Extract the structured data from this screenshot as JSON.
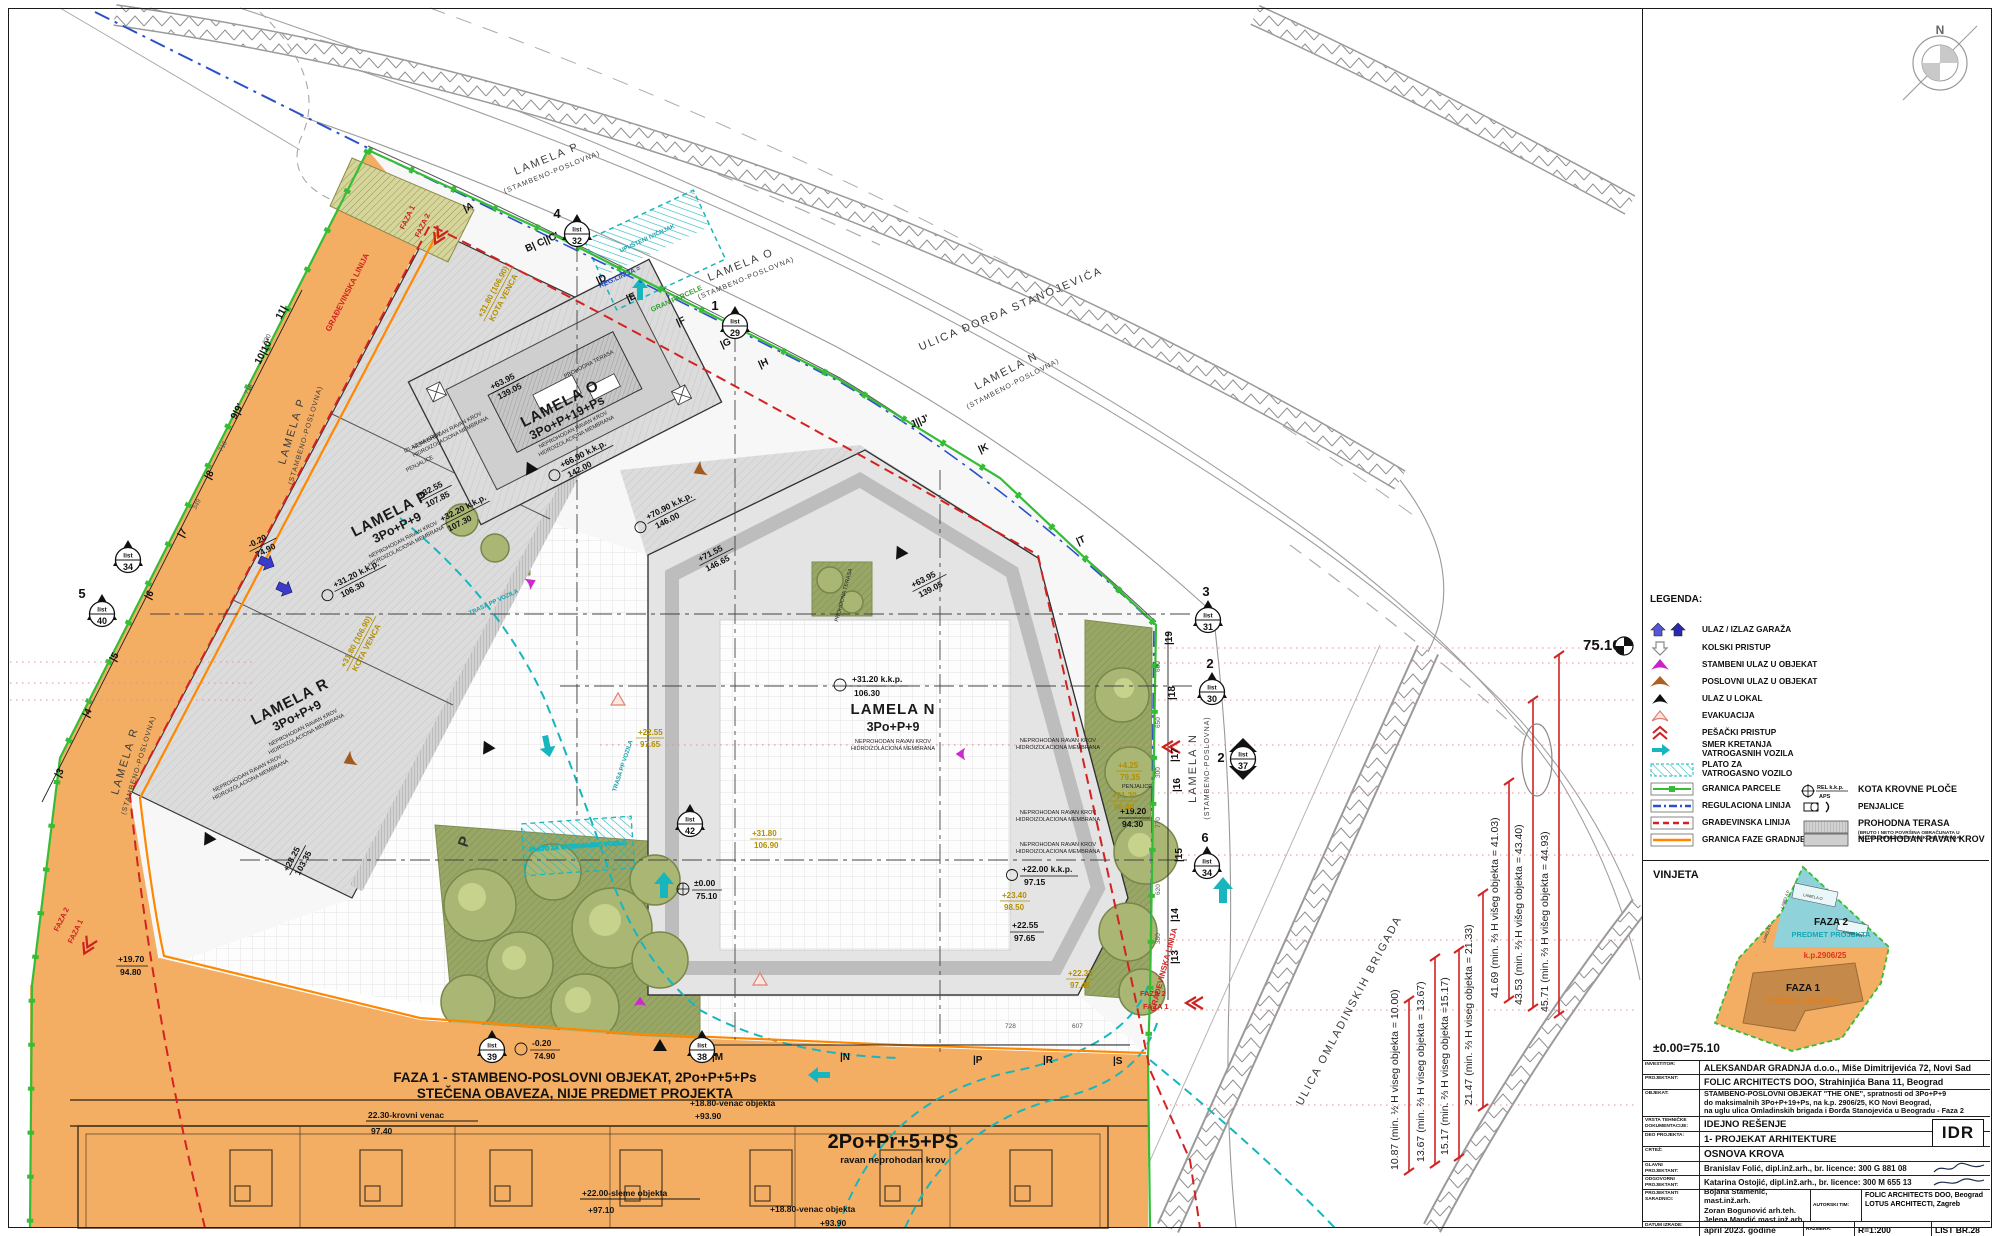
{
  "colors": {
    "orange": "#f3ae63",
    "cyan": "#17b6be",
    "green": "#35bd35",
    "red": "#d32222",
    "blue": "#2b50cc",
    "gold": "#b28f00",
    "phase_line": "#ff8800"
  },
  "compass_n": "N",
  "plan": {
    "streets": {
      "top_p": [
        "LAMELA P",
        "(STAMBENO-POSLOVNA)"
      ],
      "top_o": [
        "LAMELA O",
        "(STAMBENO-POSLOVNA)"
      ],
      "djordja": "ULICA ĐORĐA STANOJEVIĆA",
      "top_n": [
        "LAMELA N",
        "(STAMBENO-POSLOVNA)"
      ],
      "east_n": [
        "LAMELA N",
        "(STAMBENO-POSLOVNA)"
      ],
      "west_p": [
        "LAMELA P",
        "(STAMBENO-POSLOVNA)"
      ],
      "west_r": [
        "LAMELA R",
        "(STAMBENO-POSLOVNA)"
      ],
      "omladinskih": "ULICA OMLADINSKIH BRIGADA"
    },
    "buildings": {
      "o": {
        "name": "LAMELA O",
        "floors": "3Po+P+19+Ps"
      },
      "p": {
        "name": "LAMELA P",
        "floors": "3Po+P+9"
      },
      "r": {
        "name": "LAMELA R",
        "floors": "3Po+P+9"
      },
      "n": {
        "name": "LAMELA N",
        "floors": "3Po+P+9"
      }
    },
    "roof_notes": [
      "NEPROHODAN RAVAN KROV",
      "HIDROIZOLACIONA MEMBRANA"
    ],
    "faza1_title": [
      "FAZA 1 - STAMBENO-POSLOVNI OBJEKAT, 2Po+P+5+Ps",
      "STEČENA OBAVEZA, NIJE PREDMET PROJEKTA"
    ],
    "faza1_building": [
      "2Po+Pr+5+PS",
      "ravan neprohodan krov"
    ],
    "bottom_notes": {
      "krovni": [
        "22.30-krovni venac",
        "97.40"
      ],
      "venac1": [
        "+18.80-venac objekta",
        "+93.90"
      ],
      "sleme": [
        "+22.00-sleme objekta",
        "+97.10"
      ],
      "venac2": [
        "+18.80-venac objekta",
        "+93.90"
      ]
    },
    "phase": {
      "f1": "FAZA 1",
      "f2": "FAZA 2"
    },
    "notes": {
      "trasa": "TRASA PP VOZILA",
      "plato": "PLATO ZA VATROGASNO VOZILO",
      "upusteni": "UPUŠTENI IVIČNJAK",
      "reg": "REG.LINIJA =",
      "gran": "GRAN.PARCELE",
      "gradj": "GRAĐEVINSKA LINIJA",
      "penjalice": "PENJALICE",
      "prohodna": "PROHODNA TERASA",
      "izlaz": "IZLAZ NA KROV",
      "parking": "P"
    },
    "elevations": [
      {
        "a": "+70.90 k.k.p.",
        "b": "146.00"
      },
      {
        "a": "+71.55",
        "b": "146.65"
      },
      {
        "a": "+63.95",
        "b": "139.05"
      },
      {
        "a": "+63.95",
        "b": "139.05"
      },
      {
        "a": "+31.20 k.k.p.",
        "b": "106.30"
      },
      {
        "a": "+31.20 k.k.p.",
        "b": "106.30"
      },
      {
        "a": "+66.90 k.k.p.",
        "b": "142.00"
      },
      {
        "a": "+32.55",
        "b": "107.85"
      },
      {
        "a": "+32.20 k.k.p.",
        "b": "107.30"
      },
      {
        "a": "+22.00 k.k.p.",
        "b": "97.15"
      },
      {
        "a": "+22.55",
        "b": "97.65"
      },
      {
        "a": "+19.20",
        "b": "94.30"
      },
      {
        "a": "±0.00",
        "b": "75.10"
      },
      {
        "a": "-0.20",
        "b": "74.90"
      },
      {
        "a": "-0.20",
        "b": "74.90"
      },
      {
        "a": "+19.70",
        "b": "94.80"
      },
      {
        "a": "+28.25",
        "b": "103.35"
      }
    ],
    "gold": [
      {
        "a": "+31.80 (106.90)",
        "b": "KOTA VENCA"
      },
      {
        "a": "+31.80 (106.90)",
        "b": "KOTA VENCA"
      },
      {
        "a": "+31.80",
        "b": "106.90"
      },
      {
        "a": "+23.40",
        "b": "98.50"
      },
      {
        "a": "+4.25",
        "b": "79.35"
      },
      {
        "a": "+22.55",
        "b": "97.65"
      },
      {
        "a": "+21.30",
        "b": "96.40"
      },
      {
        "a": "+22.35",
        "b": "97.45"
      }
    ],
    "dims": [
      "10.87 (min. ½ H viseg objekta = 10.00)",
      "13.67 (min. ⅔ H viseg objekta = 13.67)",
      "15.17 (min. ⅔ H viseg objekta =15.17)",
      "21.47 (min. ⅔ H viseg objekta = 21.33)",
      "41.69 (min. ⅔ H višeg objekta = 41.03)",
      "43.53 (min. ⅔ H višeg objekta = 43.40)",
      "45.71 (min. ⅔ H višeg objekta = 44.93)"
    ],
    "elev_ref": "75.10",
    "grid": {
      "east": [
        "|19",
        "|18",
        "|17",
        "|16",
        "|15",
        "|14",
        "|13"
      ],
      "top": [
        "|A",
        "B| C||C'",
        "|D",
        "|E",
        "|F",
        "|G",
        "|H",
        "J||J'",
        "|K",
        "|T"
      ],
      "left": [
        "11|",
        "10|10'",
        "9|9'",
        "|8",
        "|7",
        "|6",
        "|5",
        "|4",
        "|3"
      ],
      "bottom": [
        "|M",
        "|N",
        "|P",
        "|R",
        "|S"
      ],
      "east_nums": [
        "600",
        "650",
        "300",
        "770",
        "620",
        "350"
      ],
      "west_nums": [
        "820",
        "718",
        "716",
        "349"
      ],
      "bottom_nums": [
        "728",
        "607"
      ]
    },
    "markers": [
      {
        "n": "3",
        "w": "list",
        "no": "31"
      },
      {
        "n": "2",
        "w": "list",
        "no": "30"
      },
      {
        "n": "2",
        "w": "list",
        "no": "37"
      },
      {
        "n": "6",
        "w": "list",
        "no": "34"
      },
      {
        "n": "4",
        "w": "list",
        "no": "32"
      },
      {
        "n": "1",
        "w": "list",
        "no": "29"
      },
      {
        "n": "",
        "w": "list",
        "no": "34"
      },
      {
        "n": "5",
        "w": "list",
        "no": "40"
      },
      {
        "n": "",
        "w": "list",
        "no": "42"
      },
      {
        "n": "",
        "w": "list",
        "no": "39"
      },
      {
        "n": "",
        "w": "list",
        "no": "38"
      }
    ]
  },
  "legend": {
    "title": "LEGENDA:",
    "items": [
      {
        "label": "ULAZ / IZLAZ GARAŽA"
      },
      {
        "label": "KOLSKI PRISTUP"
      },
      {
        "label": "STAMBENI ULAZ U OBJEKAT"
      },
      {
        "label": "POSLOVNI ULAZ U OBJEKAT"
      },
      {
        "label": "ULAZ U LOKAL"
      },
      {
        "label": "EVAKUACIJA"
      },
      {
        "label": "PEŠAČKI PRISTUP"
      },
      {
        "label": "SMER KRETANJA\nVATROGASNIH VOZILA"
      },
      {
        "label": "PLATO ZA\nVATROGASNO VOZILO"
      },
      {
        "label": "GRANICA PARCELE"
      },
      {
        "label": "REGULACIONA LINIJA"
      },
      {
        "label": "GRAĐEVINSKA LINIJA"
      },
      {
        "label": "GRANICA FAZE GRADNJE"
      }
    ],
    "right": [
      {
        "label": "KOTA KROVNE PLOČE"
      },
      {
        "label": "PENJALICE"
      },
      {
        "label": "PROHODNA TERASA"
      },
      {
        "label": "NEPROHODAN RAVAN KROV"
      }
    ],
    "kota_sym": [
      "REL k.k.p.",
      "APS"
    ],
    "prohodna_fine": "(BRUTO I NETO POVRŠINA OBRAČUNATA U\nSKLOPU POVRŠINE STANA KOME PRIPADA)"
  },
  "vinjeta": {
    "title": "VINJETA",
    "f2": "FAZA 2",
    "f2sub": "PREDMET PROJEKTA",
    "kp": "k.p.2906/25",
    "f1": "FAZA 1",
    "f1sub": "STEČENA OBAVEZA",
    "base": "±0.00=75.10",
    "lam": [
      "LAMELA O",
      "LAMELA P",
      "LAMELA R",
      "LAMELA N"
    ]
  },
  "titleblock": {
    "idr": "IDR",
    "rows": {
      "investitor": {
        "label": "INVESTITOR:",
        "value": "ALEKSANDAR GRADNJA d.o.o., Miše Dimitrijevića 72, Novi Sad"
      },
      "projektant": {
        "label": "PROJEKTANT:",
        "value": "FOLIC ARCHITECTS DOO, Strahinjića Bana 11, Beograd"
      },
      "objekat": {
        "label": "OBJEKAT:",
        "l1": "STAMBENO-POSLOVNI OBJEKAT \"THE ONE\", spratnosti od 3Po+P+9",
        "l2": "do maksimalnih 3Po+P+19+Ps, na k.p. 2906/25, KO Novi Beograd,",
        "l3": "na uglu ulica Omladinskih brigada i Đorđa Stanojevića u Beogradu - Faza 2"
      },
      "vrsta": {
        "label": "VRSTA TEHNIČKE\nDOKUMENTACIJE:",
        "value": "IDEJNO REŠENJE"
      },
      "deo": {
        "label": "DEO PROJEKTA:",
        "value": "1- PROJEKAT ARHITEKTURE"
      },
      "crtez": {
        "label": "CRTEŽ:",
        "value": "OSNOVA KROVA"
      },
      "glavni": {
        "label": "GLAVNI\nPROJEKTANT:",
        "value": "Branislav Folić, dipl.inž.arh., br. licence: 300 G 881 08"
      },
      "odgovorni": {
        "label": "ODGOVORNI\nPROJEKTANT:",
        "value": "Katarina Ostojić, dipl.inž.arh., br. licence: 300 M 655 13"
      },
      "saradnici": {
        "label": "PROJEKTANTI\nSARADNICI:",
        "v1": "Bojana Stamenić, mast.inž.arh.",
        "v2": "Zoran Bogunović arh.teh.",
        "v3": "Jelena Mandić mast.inž.arh."
      },
      "autorski": {
        "label": "AUTORSKI TIM:",
        "v1": "FOLIC ARCHITECTS DOO, Beograd",
        "v2": "LOTUS ARCHITECTI, Zagreb"
      },
      "datum": {
        "label": "DATUM IZRADE:",
        "value": "april 2023. godine"
      },
      "razmera": {
        "label": "RAZMERA:",
        "value": "R=1:200"
      },
      "list": {
        "value": "LIST BR.28"
      }
    }
  }
}
